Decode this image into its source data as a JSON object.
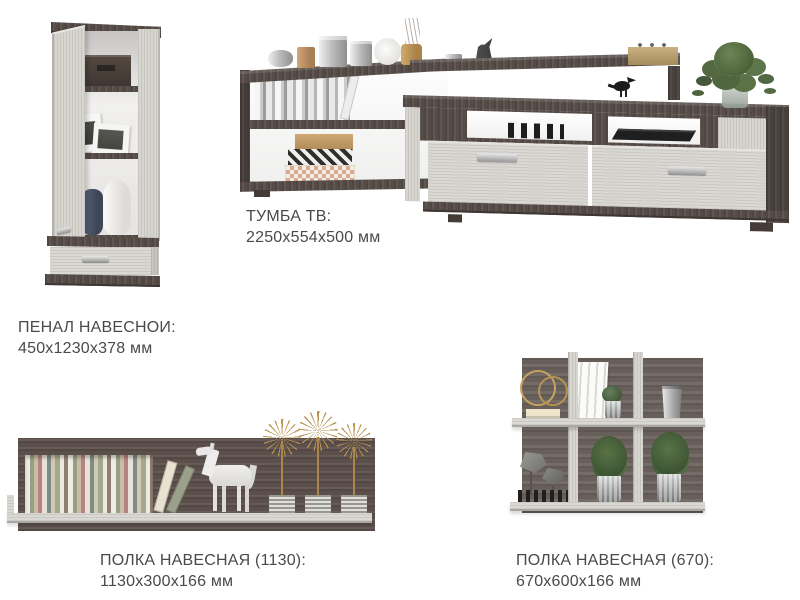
{
  "page": {
    "background": "#ffffff",
    "type": "furniture-catalog-sheet"
  },
  "colors": {
    "dark_wood": "#584e4a",
    "dark_wood_panel": "#6c635e",
    "light_wood": "#d7d5d0",
    "text": "#4a4a4a",
    "gold_accent": "#b99250",
    "plant_green": "#4b6239"
  },
  "products": [
    {
      "id": "penal",
      "title": "ПЕНАЛ НАВЕСНОИ:",
      "dimensions": "450х1230х378 мм"
    },
    {
      "id": "tumba-tv",
      "title": "ТУМБА ТВ:",
      "dimensions": "2250х554х500 мм"
    },
    {
      "id": "polka1130",
      "title": "ПОЛКА НАВЕСНАЯ (1130):",
      "dimensions": "1130х300х166 мм"
    },
    {
      "id": "polka670",
      "title": "ПОЛКА НАВЕСНАЯ (670):",
      "dimensions": "670х600х166 мм"
    }
  ]
}
